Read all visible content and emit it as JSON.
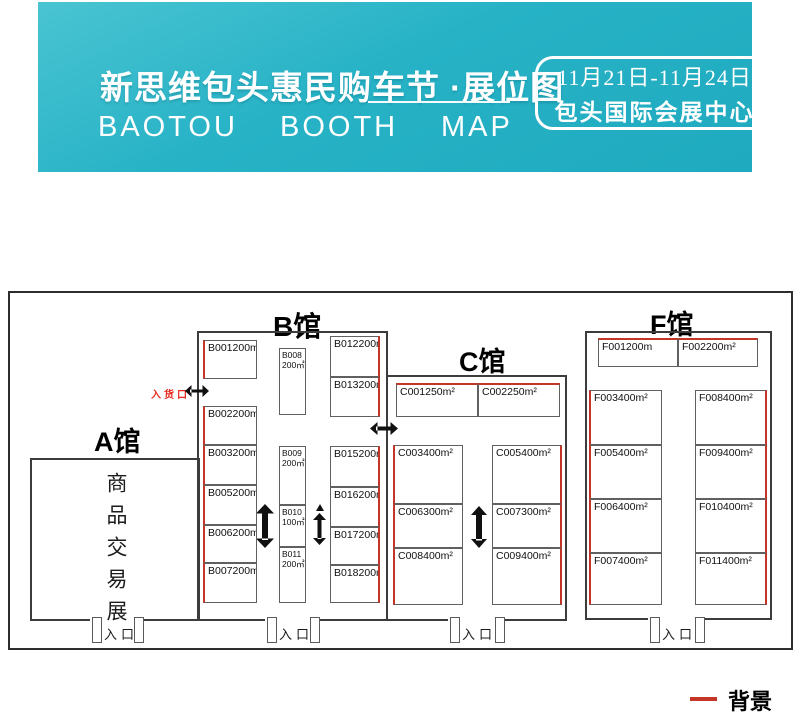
{
  "header": {
    "title": "新思维包头惠民购车节 ·展位图",
    "words": {
      "w1": "BAOTOU",
      "w2": "BOOTH",
      "w3": "MAP"
    },
    "badge": {
      "dates": "11月21日-11月24日",
      "venue": "包头国际会展中心"
    },
    "colors": {
      "band_teal": "#27b2c6",
      "accent_red": "#c23527",
      "goods_label_red": "#e8281e"
    }
  },
  "map": {
    "hall_labels": {
      "a": "A馆",
      "b": "B馆",
      "c": "C馆",
      "f": "F馆"
    },
    "hall_a_text": "商品交易展",
    "goods_entrance_label": "入货口",
    "entrance_label": "入口",
    "booths": {
      "B001": {
        "label": "B001200m"
      },
      "B002": {
        "label": "B002200m²"
      },
      "B003": {
        "label": "B003200m²"
      },
      "B005": {
        "label": "B005200m²"
      },
      "B006": {
        "label": "B006200m²"
      },
      "B007": {
        "label": "B007200m²"
      },
      "B012": {
        "label": "B012200m²"
      },
      "B013": {
        "label": "B013200m²"
      },
      "B015": {
        "label": "B015200m²"
      },
      "B016": {
        "label": "B016200m²"
      },
      "B017": {
        "label": "B017200m²"
      },
      "B018": {
        "label": "B018200m²"
      },
      "C001": {
        "label": "C001250m²"
      },
      "C002": {
        "label": "C002250m²"
      },
      "C003": {
        "label": "C003400m²"
      },
      "C005": {
        "label": "C005400m²"
      },
      "C006": {
        "label": "C006300m²"
      },
      "C007": {
        "label": "C007300m²"
      },
      "C008": {
        "label": "C008400m²"
      },
      "C009": {
        "label": "C009400m²"
      },
      "F001": {
        "label": "F001200m"
      },
      "F002": {
        "label": "F002200m²"
      },
      "F003": {
        "label": "F003400m²"
      },
      "F005": {
        "label": "F005400m²"
      },
      "F006": {
        "label": "F006400m²"
      },
      "F007": {
        "label": "F007400m²"
      },
      "F008": {
        "label": "F008400m²"
      },
      "F009": {
        "label": "F009400m²"
      },
      "F010": {
        "label": "F010400m²"
      },
      "F011": {
        "label": "F011400m²"
      }
    },
    "booths_small": {
      "B008": {
        "id": "B008",
        "area": "200㎡"
      },
      "B009": {
        "id": "B009",
        "area": "200㎡"
      },
      "B010": {
        "id": "B010",
        "area": "100㎡"
      },
      "B011": {
        "id": "B011",
        "area": "200㎡"
      }
    }
  },
  "legend": {
    "label": "背景",
    "swatch_color": "#c23527"
  }
}
